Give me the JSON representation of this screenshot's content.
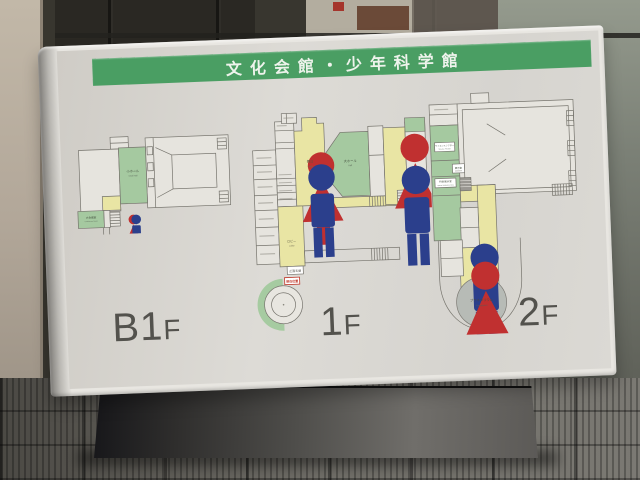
{
  "title": "文化会館・少年科学館",
  "floor_labels": {
    "b1f": {
      "num": "B1",
      "f": "F"
    },
    "f1": {
      "num": "1",
      "f": "F"
    },
    "f2": {
      "num": "2",
      "f": "F"
    }
  },
  "b1f": {
    "small_hall_jp": "小ホール",
    "small_hall_en": "Small Hall",
    "conference_jp": "大会議室",
    "conference_en": "Conference Room"
  },
  "f1": {
    "stage_jp": "舞台",
    "stage_en": "Stage",
    "hall_jp": "大ホール",
    "hall_en": "Hall",
    "lobby_jp": "ロビー",
    "lobby_en": "Lobby",
    "entrance_jp": "正面玄関",
    "marker_jp": "現在位置"
  },
  "f2": {
    "science_theater_jp": "サイエンスシアター",
    "science_theater_en": "Science Theater",
    "exhibition_jp": "展示室",
    "special_exhibition_jp": "特別展示室",
    "special_exhibition_en": "Special Exhibition Room",
    "planetarium_jp": "プラネタリウム",
    "planetarium_en": "Planetarium"
  },
  "colors": {
    "title_bar_green": "#4a9e63",
    "plan_room_green": "#a5c9a0",
    "plan_room_yellow": "#e9e5a4",
    "planetarium_gray": "#b7bbb6",
    "marker_red": "#c0392b",
    "icon_man_blue": "#2b3f8c",
    "icon_woman_red": "#c03030"
  }
}
